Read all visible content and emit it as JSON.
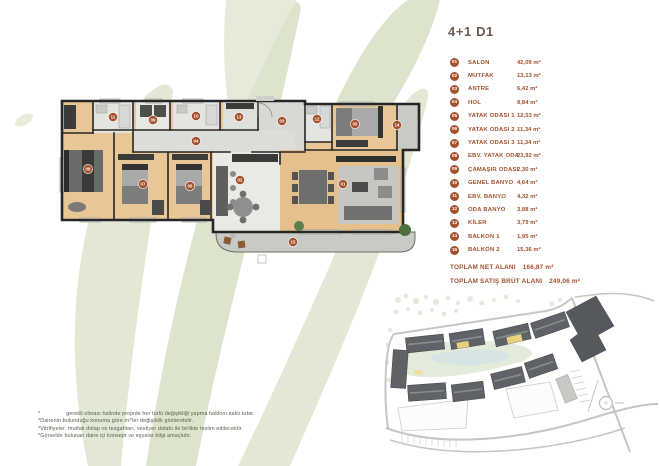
{
  "header": {
    "title": "4+1 D1"
  },
  "legend": {
    "items": [
      {
        "num": "01",
        "label": "SALON",
        "area": "42,09 m²"
      },
      {
        "num": "02",
        "label": "MUTFAK",
        "area": "13,13 m²"
      },
      {
        "num": "03",
        "label": "ANTRE",
        "area": "6,42 m²"
      },
      {
        "num": "04",
        "label": "HOL",
        "area": "9,84 m²"
      },
      {
        "num": "05",
        "label": "YATAK ODASI 1",
        "area": "12,53 m²"
      },
      {
        "num": "06",
        "label": "YATAK ODASI 2",
        "area": "11,34 m²"
      },
      {
        "num": "07",
        "label": "YATAK ODASI 3",
        "area": "11,34 m²"
      },
      {
        "num": "08",
        "label": "EBV. YATAK ODA",
        "area": "23,92 m²"
      },
      {
        "num": "09",
        "label": "ÇAMAŞIR ODASI",
        "area": "2,30 m²"
      },
      {
        "num": "10",
        "label": "GENEL BANYO",
        "area": "4,64 m²"
      },
      {
        "num": "11",
        "label": "EBV. BANYO",
        "area": "4,32 m²"
      },
      {
        "num": "12",
        "label": "ODA BANYO",
        "area": "3,88 m²"
      },
      {
        "num": "13",
        "label": "KİLER",
        "area": "3,79 m²"
      },
      {
        "num": "14",
        "label": "BALKON 1",
        "area": "1,95 m²"
      },
      {
        "num": "15",
        "label": "BALKON 2",
        "area": "15,36 m²"
      }
    ]
  },
  "totals": {
    "net_label": "TOPLAM NET ALANI",
    "net_value": "166,87 m²",
    "gross_label": "TOPLAM SATIŞ BRÜT ALANI",
    "gross_value": "249,06 m²"
  },
  "disclaimers": [
    "* gerekli olması halinde projede her türlü değişikliği yapma hakkını saklı tutar.",
    "*Dairenin bulunduğu konuma göre m²'ler değişiklik gösterebilir.",
    "*Vitrifiyeler, mutfak dolap ve tezgahları, vestiyer dolabı ile birlikte teslim edilecektir.",
    "*Görselde bulunan daire içi konsept ve eşyalar bilgi amaçlıdır."
  ],
  "floorplan": {
    "markers": [
      {
        "num": "01",
        "x": 343,
        "y": 184
      },
      {
        "num": "02",
        "x": 240,
        "y": 180
      },
      {
        "num": "03",
        "x": 282,
        "y": 121
      },
      {
        "num": "04",
        "x": 196,
        "y": 141
      },
      {
        "num": "05",
        "x": 355,
        "y": 124
      },
      {
        "num": "06",
        "x": 190,
        "y": 186
      },
      {
        "num": "07",
        "x": 143,
        "y": 184
      },
      {
        "num": "08",
        "x": 88,
        "y": 169
      },
      {
        "num": "09",
        "x": 153,
        "y": 120
      },
      {
        "num": "10",
        "x": 196,
        "y": 116
      },
      {
        "num": "11",
        "x": 113,
        "y": 117
      },
      {
        "num": "12",
        "x": 317,
        "y": 119
      },
      {
        "num": "13",
        "x": 239,
        "y": 117
      },
      {
        "num": "14",
        "x": 397,
        "y": 125
      },
      {
        "num": "15",
        "x": 293,
        "y": 242
      }
    ]
  },
  "colors": {
    "accent": "#a3502b",
    "title": "#6d5c51",
    "leaf": "#e2e8d4",
    "wood": "#e8c695",
    "wall": "#262626",
    "unit_highlight": "#e6d07e"
  }
}
